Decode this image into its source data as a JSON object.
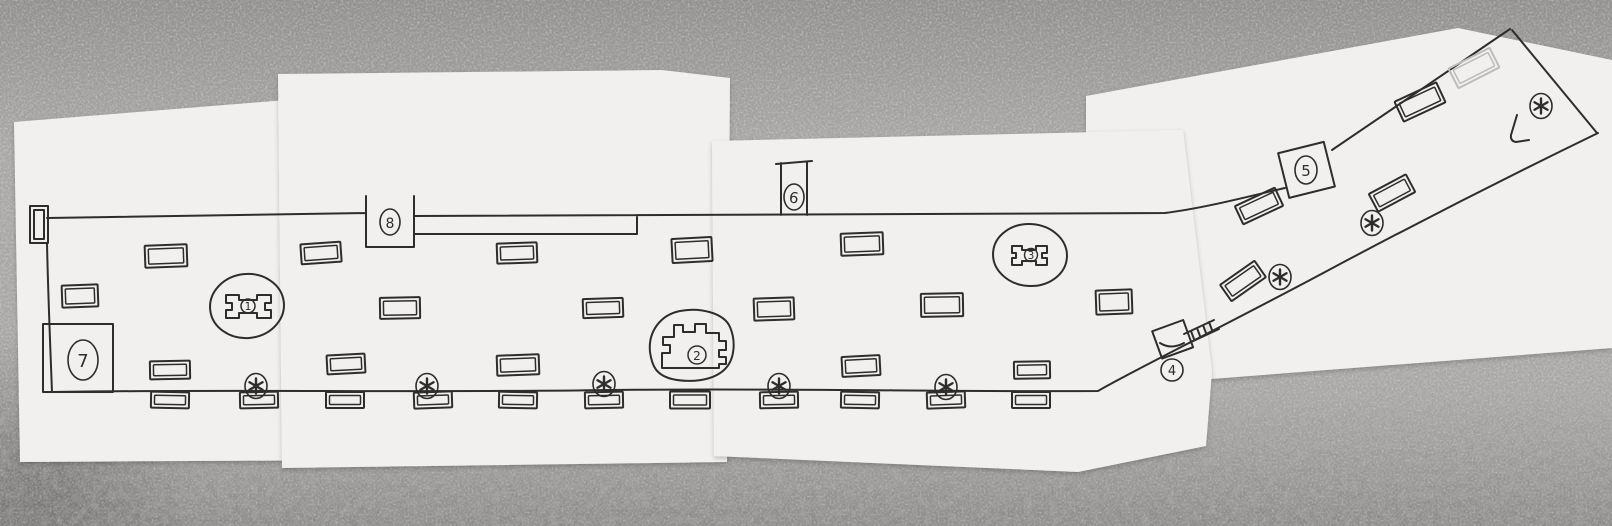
{
  "colors": {
    "ink": "#2e2d2b",
    "ink_faint": "#bdbcba",
    "paper": "#f1f0ee",
    "paper_dim": "#cfcecb",
    "floor": "#a8a7a5",
    "floor_dark": "#8d8c8a"
  },
  "markers": {
    "m1": {
      "label": "1"
    },
    "m2": {
      "label": "2"
    },
    "m3": {
      "label": "3"
    },
    "m4": {
      "label": "4"
    },
    "m5": {
      "label": "5"
    },
    "m6": {
      "label": "6"
    },
    "m7": {
      "label": "7"
    },
    "m8": {
      "label": "8"
    }
  },
  "icons": {
    "asterisk": "six-spoke-asterisk",
    "stairs": "hatched-strip",
    "corner_mark": "L-bracket"
  }
}
